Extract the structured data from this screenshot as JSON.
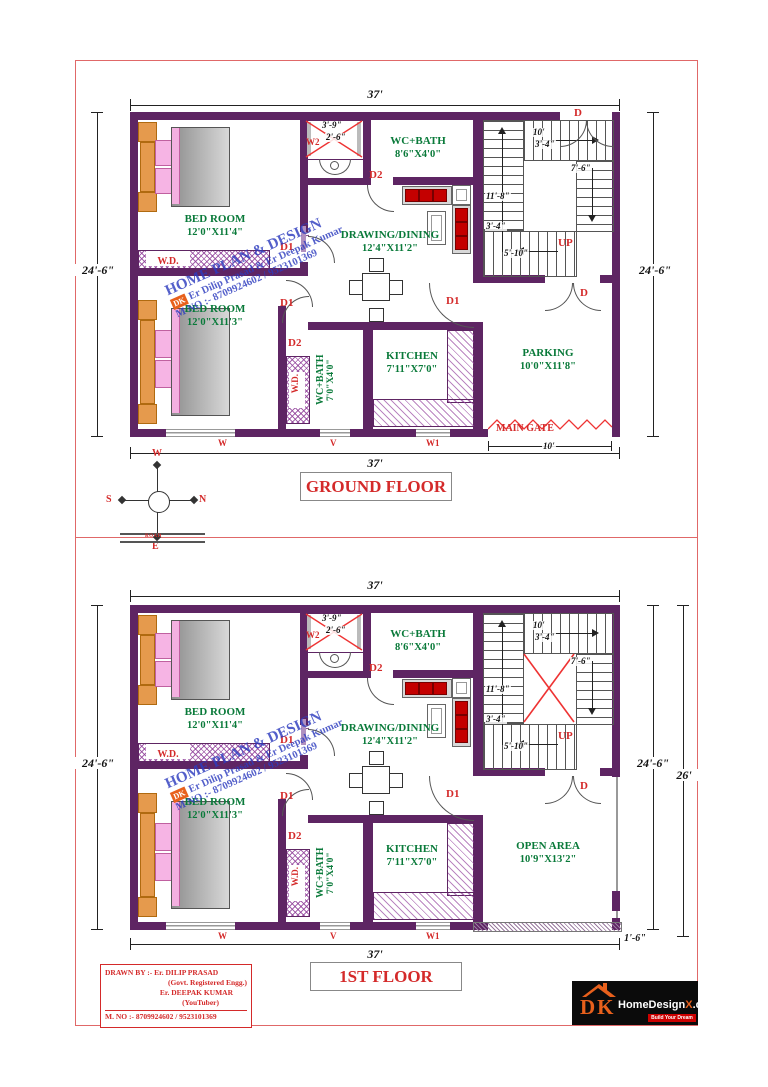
{
  "colors": {
    "wall": "#5e2563",
    "label_green": "#0a7a3a",
    "label_red": "#d42a2a",
    "watermark_blue": "#2d3cbe",
    "logo_orange": "#e8601c",
    "border_red": "#e06868"
  },
  "floors": {
    "ground": {
      "title": "GROUND FLOOR",
      "dim_top": "37'",
      "dim_bottom": "37'",
      "dim_left": "24'-6\"",
      "dim_right": "24'-6\"",
      "bedroom1": {
        "name": "BED ROOM",
        "size": "12'0\"X11'4\""
      },
      "bedroom2": {
        "name": "BED ROOM",
        "size": "12'0\"X11'3\""
      },
      "wc_top": {
        "name": "WC+BATH",
        "size": "8'6\"X4'0\""
      },
      "drawing": {
        "name": "DRAWING/DINING",
        "size": "12'4\"X11'2\""
      },
      "kitchen": {
        "name": "KITCHEN",
        "size": "7'11\"X7'0\""
      },
      "parking": {
        "name": "PARKING",
        "size": "10'0\"X11'8\""
      },
      "wc_bottom": {
        "name": "WC+BATH",
        "size": "7'0\"X4'0\""
      },
      "shaft": {
        "w": "3'-9\"",
        "h": "2'-6\"",
        "label": "W2"
      },
      "stairs": {
        "d10": "10'",
        "d34a": "3'-4\"",
        "d76": "7'-6\"",
        "d118": "11'-8\"",
        "d34b": "3'-4\"",
        "d510": "5'-10\"",
        "up": "UP"
      },
      "doors": {
        "d": "D",
        "d1": "D1",
        "d2": "D2"
      },
      "wd": "W.D.",
      "tv": "TV",
      "windows": {
        "w": "W",
        "v": "V",
        "w1": "W1"
      },
      "gate": {
        "label": "MAIN GATE",
        "dim": "10'"
      }
    },
    "first": {
      "title": "1ST FLOOR",
      "dim_top": "37'",
      "dim_bottom": "37'",
      "dim_left": "24'-6\"",
      "dim_right": "24'-6\"",
      "dim_right2": "26'",
      "dim_offset": "1'-6\"",
      "bedroom1": {
        "name": "BED ROOM",
        "size": "12'0\"X11'4\""
      },
      "bedroom2": {
        "name": "BED ROOM",
        "size": "12'0\"X11'3\""
      },
      "wc_top": {
        "name": "WC+BATH",
        "size": "8'6\"X4'0\""
      },
      "drawing": {
        "name": "DRAWING/DINING",
        "size": "12'4\"X11'2\""
      },
      "kitchen": {
        "name": "KITCHEN",
        "size": "7'11\"X7'0\""
      },
      "open_area": {
        "name": "OPEN AREA",
        "size": "10'9\"X13'2\""
      },
      "wc_bottom": {
        "name": "WC+BATH",
        "size": "7'0\"X4'0\""
      },
      "shaft": {
        "w": "3'-9\"",
        "h": "2'-6\"",
        "label": "W2"
      },
      "stairs": {
        "d10": "10'",
        "d34a": "3'-4\"",
        "d76": "7'-6\"",
        "d118": "11'-8\"",
        "d34b": "3'-4\"",
        "d510": "5'-10\"",
        "up": "UP"
      },
      "doors": {
        "d": "D",
        "d1": "D1",
        "d2": "D2"
      },
      "wd": "W.D.",
      "tv": "TV",
      "windows": {
        "w": "W",
        "v": "V",
        "w1": "W1"
      }
    }
  },
  "compass": {
    "n": "N",
    "s": "S",
    "e": "E",
    "w": "W",
    "road": "ROAD"
  },
  "watermark": {
    "badge": "DK",
    "l1": "HOME PLAN & DESIGN",
    "l2": "Er Dilip Prasad & Er Deepak Kumar",
    "l3": "M NO :- 8709924602 / 9523101369"
  },
  "credits": {
    "l1": "DRAWN BY :- Er. DILIP PRASAD",
    "l2": "(Govt. Registered Engg.)",
    "l3": "Er. DEEPAK KUMAR",
    "l4": "(YouTuber)",
    "l5": "M. NO :- 8709924602 / 9523101369"
  },
  "logo": {
    "dk": "DK",
    "name_a": "HomeDesign",
    "name_x": "X",
    "name_b": ".com",
    "tagline": "Build Your Dream"
  }
}
